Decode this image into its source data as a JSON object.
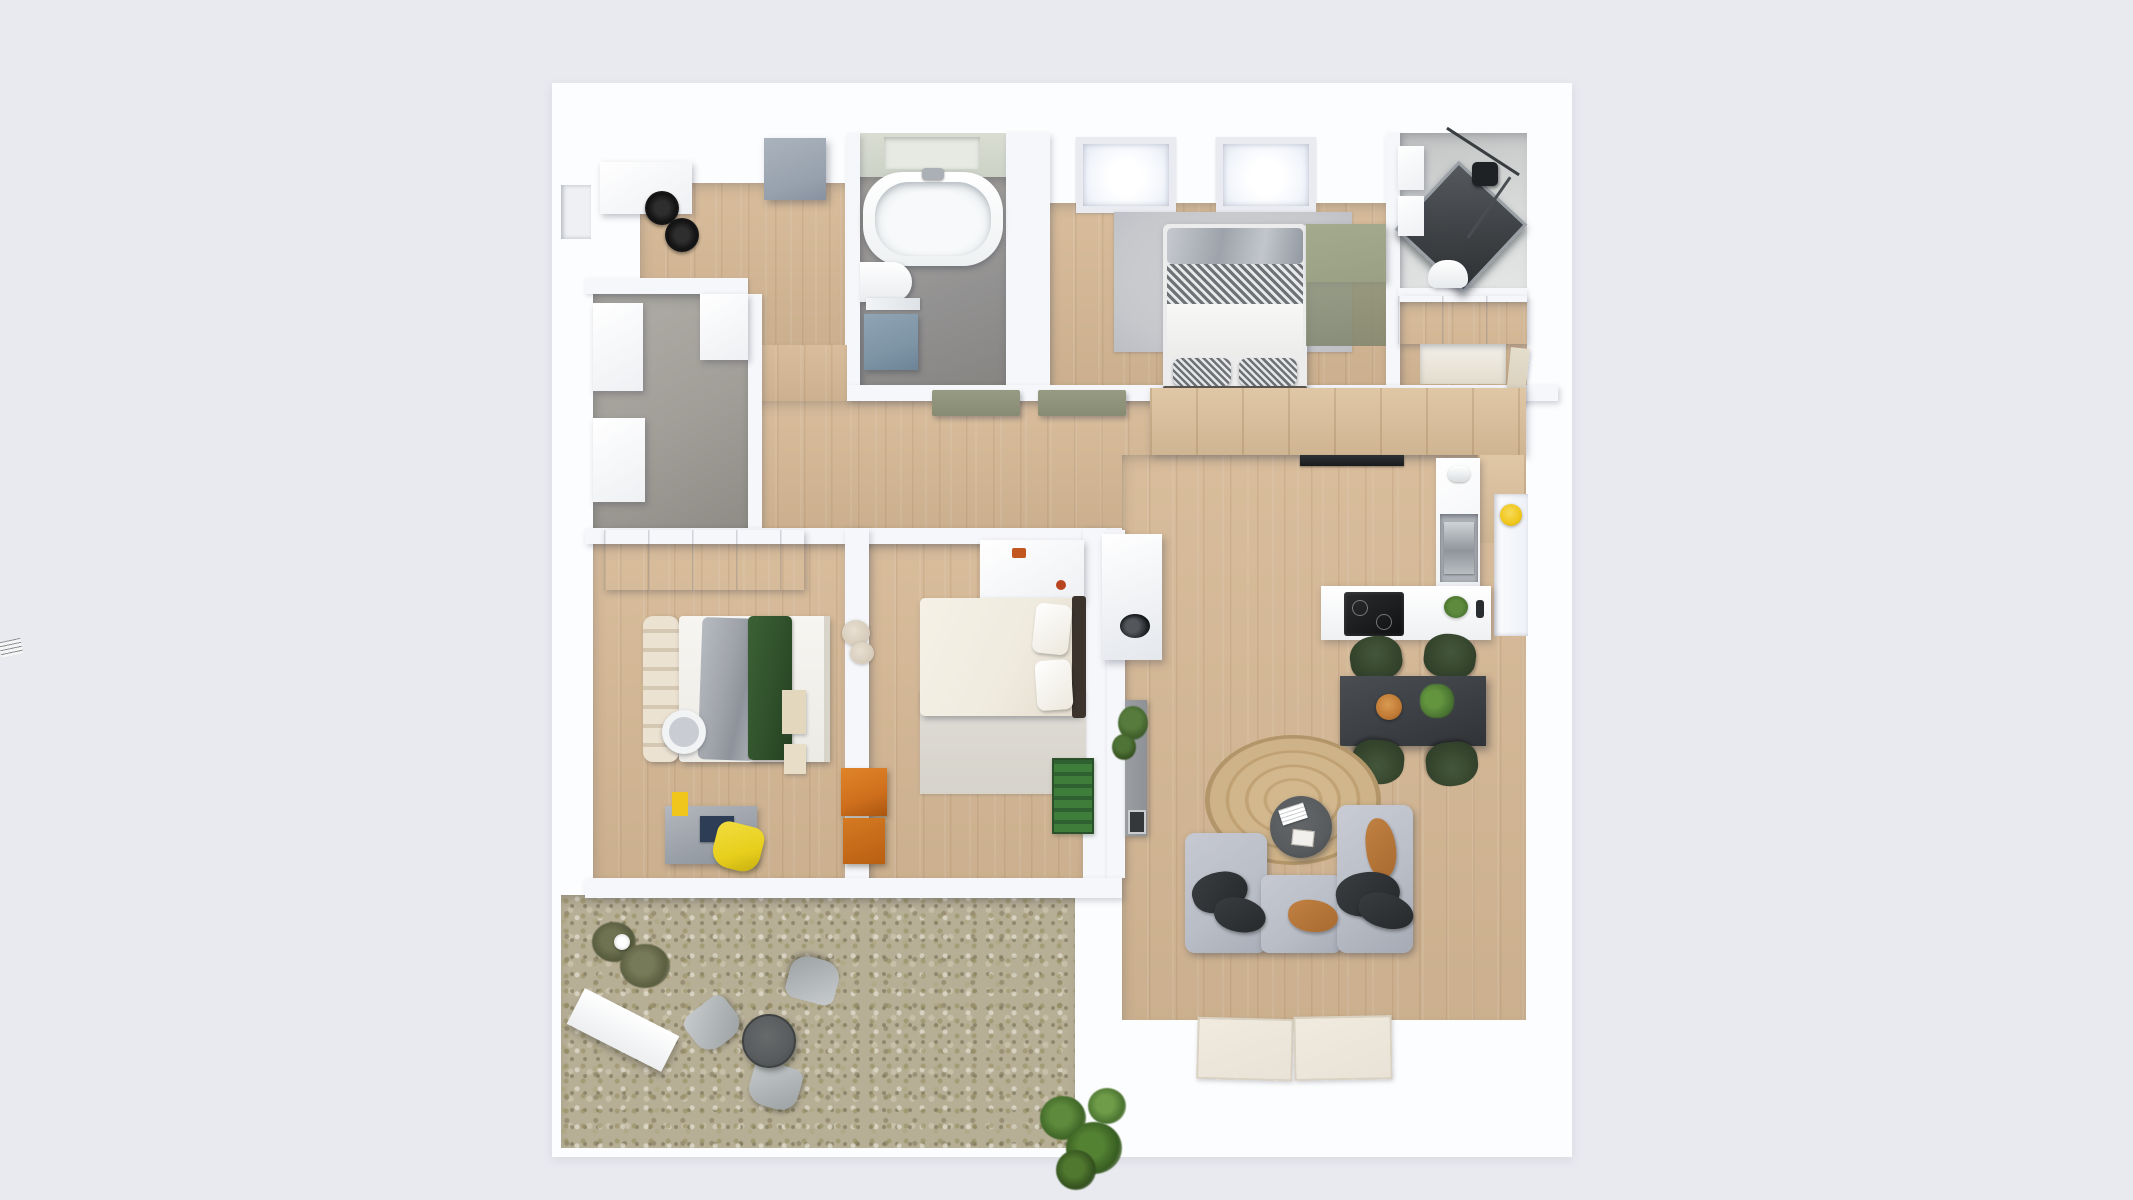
{
  "scene": {
    "type": "3d-floorplan-top-down-render",
    "description": "Top-down 3D architectural rendering of a furnished apartment with patio; no text labels visible in the image",
    "text_visible": ""
  },
  "palette": {
    "bg": "#e9eaf0",
    "plate": "#fcfdfe",
    "wallTop": "#f6f7fa",
    "wood": "#d6b996",
    "kitchenWood": "#dcc09b",
    "bathFloor": "#929191",
    "storageFloor": "#a19e98",
    "patioBase": "#b7ae96",
    "rugGray": "#c7c8cc",
    "sofa": "#b9bdc6",
    "pillowDark": "#26292b",
    "pillowTan": "#a86a30",
    "tableDark": "#3c4044",
    "chairGreen": "#31402a",
    "counter": "#eef0f2",
    "cooktop": "#1b1c1e",
    "oliveDoor": "#868b72",
    "greenDesk": "#99a083",
    "yellowChair": "#e8cf1d",
    "yellowDeco": "#f0c61c",
    "orangeBox": "#cf6f1d",
    "bedGreenThrow": "#31522c",
    "blanketGray": "#a3a7ad",
    "creamHeadboard": "#e6ddcd",
    "vanityBlue": "#7e95a6",
    "lockerGray": "#97a1ad",
    "showerGlass": "#3c4043",
    "chrome": "#aab0b6",
    "plantGreen": "#4e7a33",
    "plantDark": "#3c6426",
    "terracotta": "#c07a35",
    "matBeige": "#e9e2d6",
    "duvetCream": "#f0ebdf",
    "bedFrameDark": "#3b332c",
    "patioTable": "#595c5e",
    "sideboardGray": "#8e9296",
    "greenMat": "#3f7d3b"
  },
  "rooms": [
    {
      "id": "entry-hall",
      "floor": "wood",
      "furniture": [
        "wall-cabinet",
        "hat-1",
        "hat-2",
        "tall-locker",
        "front-door-recess"
      ]
    },
    {
      "id": "bathroom",
      "floor": "gray-tile",
      "furniture": [
        "bathtub",
        "toilet",
        "vanity-mirror",
        "vanity-cabinet"
      ]
    },
    {
      "id": "master-bedroom",
      "floor": "wood",
      "furniture": [
        "skylight-1",
        "skylight-2",
        "area-rug",
        "double-bed",
        "wall-desk-green"
      ]
    },
    {
      "id": "shower-room",
      "floor": "light-tile",
      "furniture": [
        "shower-enclosure",
        "shower-head",
        "washbasin",
        "toilet"
      ]
    },
    {
      "id": "wardrobe-hall",
      "floor": "wood",
      "furniture": [
        "closet-band",
        "door-leaf"
      ]
    },
    {
      "id": "storage-room",
      "floor": "concrete",
      "furniture": [
        "wall-cabinet-upper",
        "wall-cabinet-lower",
        "column"
      ]
    },
    {
      "id": "hallway",
      "floor": "wood",
      "furniture": [
        "door-panel-1",
        "door-panel-2",
        "basin-console"
      ]
    },
    {
      "id": "kitchen",
      "floor": "wood",
      "furniture": [
        "tall-cabinet-band",
        "extractor-vent",
        "appliance-column",
        "coffee-machine",
        "peninsula-counter",
        "cooktop",
        "counter-plant",
        "window",
        "yellow-wall-deco"
      ]
    },
    {
      "id": "dining-area",
      "floor": "wood",
      "furniture": [
        "dining-table",
        "chair-nw",
        "chair-ne",
        "chair-sw",
        "chair-se",
        "serving-bowl",
        "table-plant"
      ]
    },
    {
      "id": "living-room",
      "floor": "wood",
      "furniture": [
        "jute-rug",
        "coffee-table",
        "magazines",
        "sofa-left",
        "sofa-bottom",
        "sofa-right",
        "pillows",
        "sideboard",
        "sideboard-plant",
        "doormat-1",
        "doormat-2"
      ]
    },
    {
      "id": "kids-bedroom",
      "floor": "wood",
      "furniture": [
        "wardrobe",
        "bed-headboard",
        "bed",
        "gray-blanket",
        "green-throw",
        "desk",
        "desk-lamp",
        "yellow-chair"
      ]
    },
    {
      "id": "second-bedroom",
      "floor": "wood",
      "furniture": [
        "wall-desk",
        "double-bed",
        "pillows",
        "bed-rug",
        "teddy-bear",
        "toy-box-1",
        "toy-box-2",
        "green-play-mat",
        "wall-shelves"
      ]
    },
    {
      "id": "patio",
      "floor": "gravel-planting",
      "furniture": [
        "white-planter-bench",
        "shrub",
        "bistro-table",
        "patio-chair-1",
        "patio-chair-2",
        "patio-chair-3",
        "corner-plant"
      ]
    }
  ],
  "counts": {
    "skylights": 2,
    "dining_chairs": 4,
    "patio_chairs": 3,
    "bedrooms": 3,
    "doormats": 2
  }
}
